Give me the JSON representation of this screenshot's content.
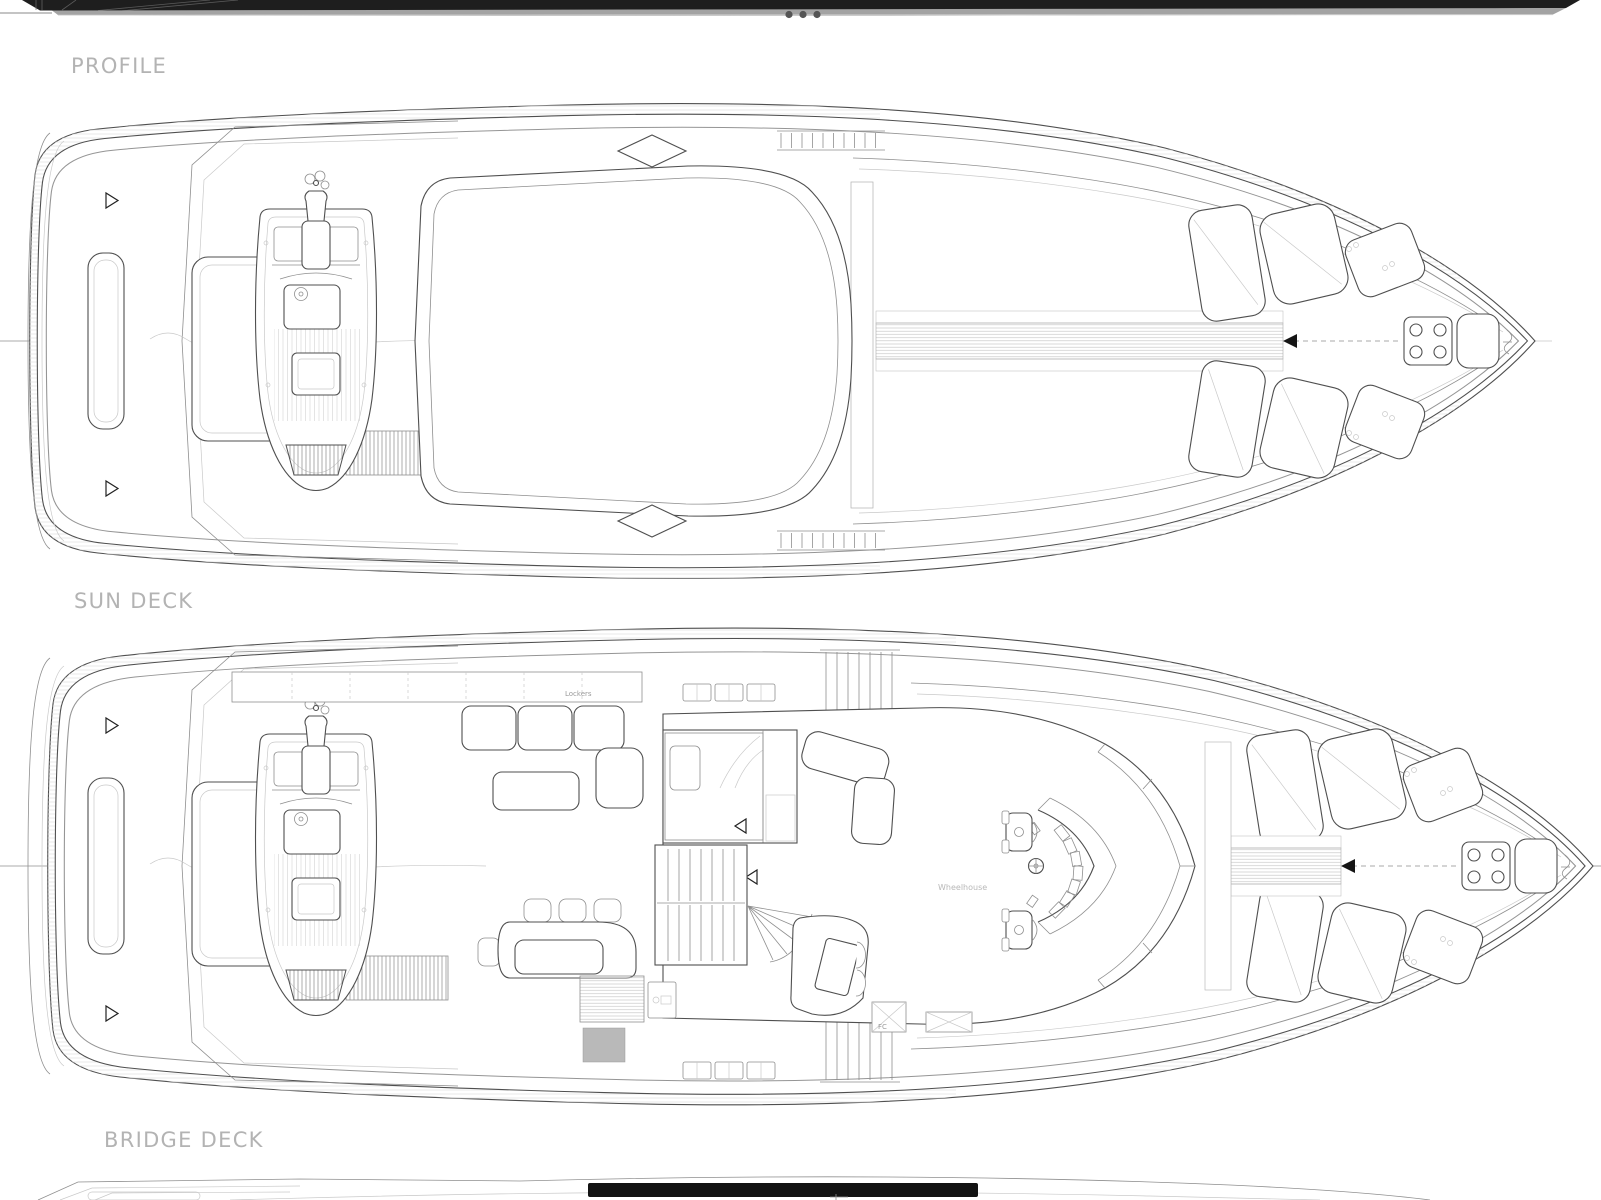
{
  "page": {
    "title_labels": {
      "profile": "PROFILE",
      "sun_deck": "SUN DECK",
      "bridge_deck": "BRIDGE DECK"
    },
    "plan_annotations": {
      "lockers": "Lockers",
      "wheelhouse": "Wheelhouse",
      "fire_control": "FC"
    },
    "profile_strip": {
      "porthole_dots": 3
    },
    "colors": {
      "background": "#ffffff",
      "label_text": "#b3b3b3",
      "small_annotation_text": "#b8b8b8",
      "primary_line": "#4f4f4f",
      "secondary_line": "#8f8f8f",
      "faint_line": "#c9c9c9",
      "profile_hull_dark": "#1e1e1e",
      "profile_hull_band": "#a3a3a3",
      "solid_black_bar": "#121212"
    }
  }
}
